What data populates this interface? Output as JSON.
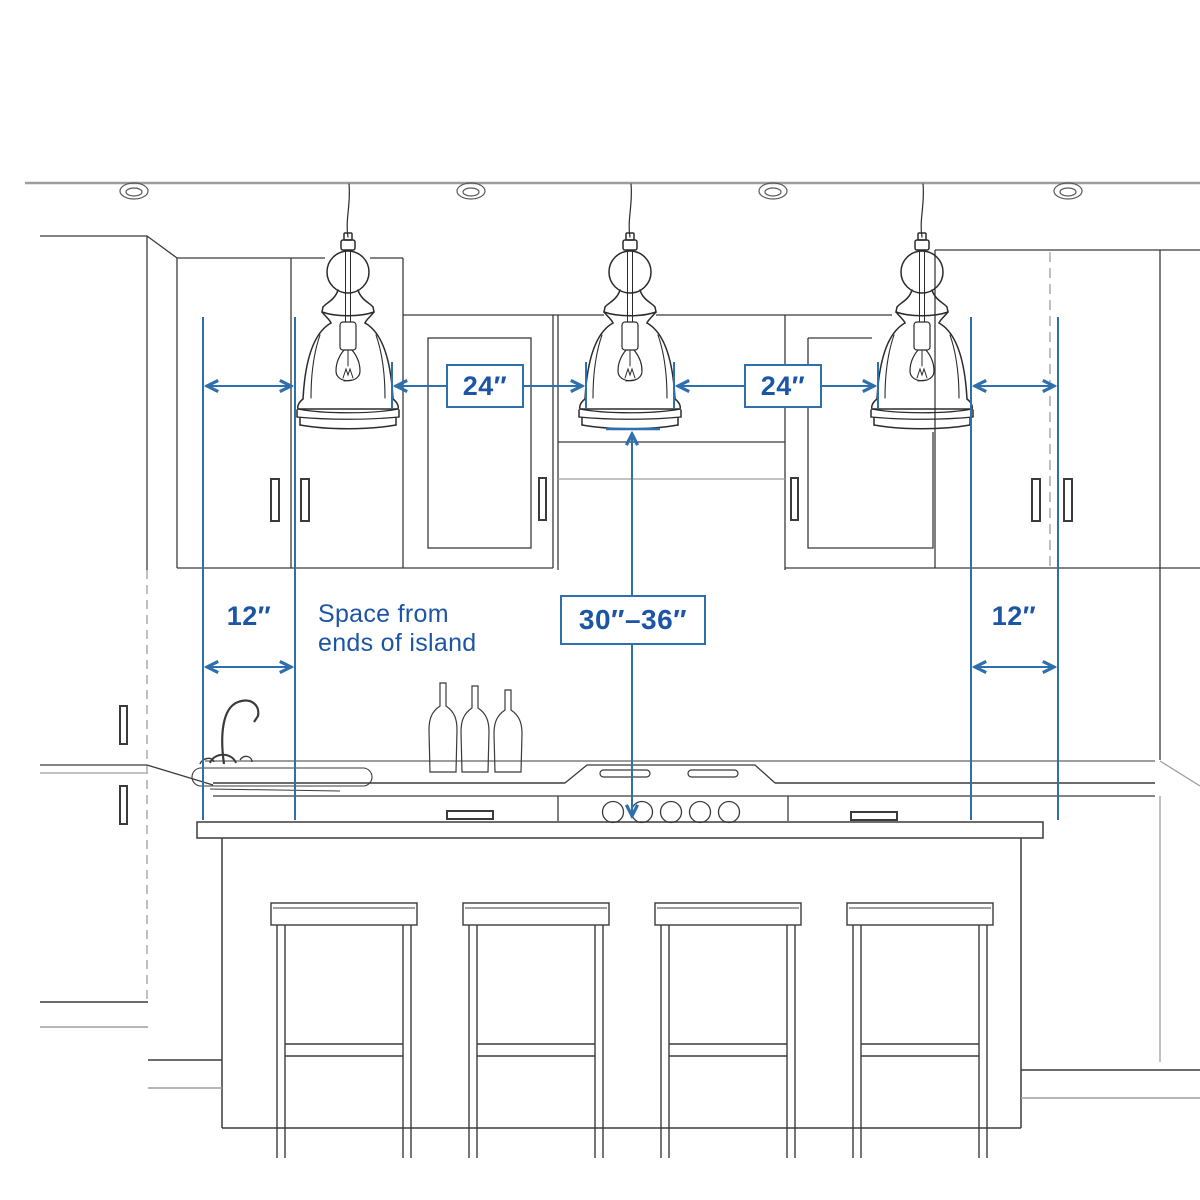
{
  "figure": {
    "type": "kitchen-island-pendant-spacing-diagram",
    "pendant_count": 3,
    "stool_count": 4,
    "recessed_light_count": 4
  },
  "labels": {
    "spacing_between_pendants_left": "24″",
    "spacing_between_pendants_right": "24″",
    "height_above_island": "30″–36″",
    "end_space_left": "12″",
    "end_space_right": "12″"
  },
  "note": {
    "line1": "Space from",
    "line2": "ends of island"
  },
  "colors": {
    "dimension_line": "#2e6fae",
    "label_text": "#1d55a6",
    "sketch_dark": "#3b3b3b",
    "sketch_light": "#9e9e9e",
    "background": "#ffffff"
  }
}
